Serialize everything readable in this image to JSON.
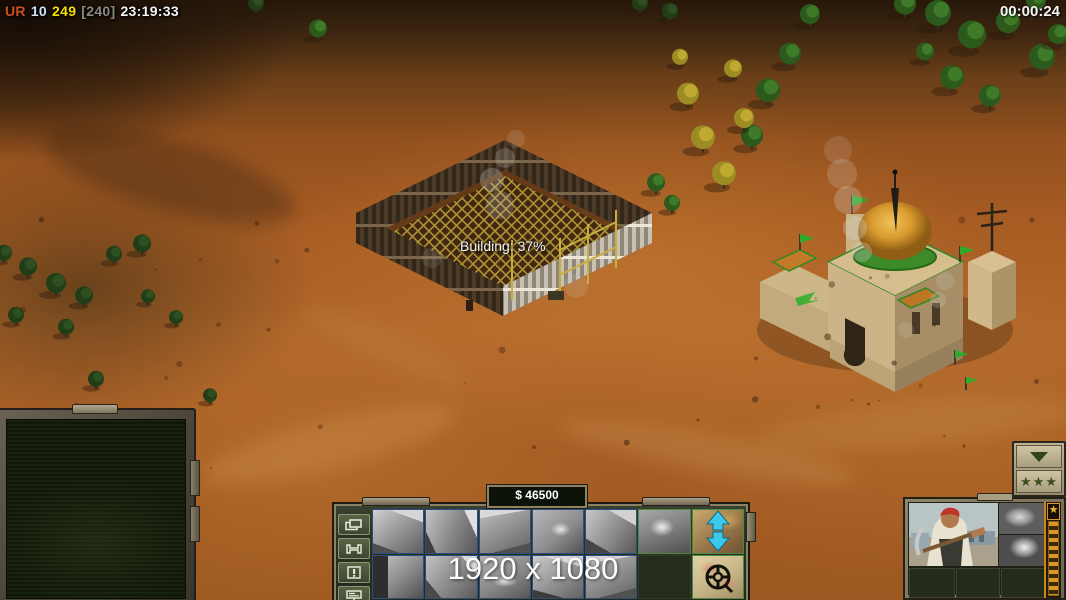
{
  "hud": {
    "score": {
      "tag": "UR",
      "num1": "10",
      "num2": "249",
      "bracket": "[240]",
      "clock": "23:19:33"
    },
    "mission_timer": "00:00:24",
    "building_progress_label": "Building: 37%",
    "resolution_overlay": "1920 x 1080"
  },
  "colors": {
    "score_tag": "#cf4f1d",
    "score_num1": "#cfe4f4",
    "score_num2": "#f8e000",
    "score_bracket": "#8a8a84",
    "clock": "#f4f4f4",
    "timer": "#f5f5f5",
    "money_text": "#ffffff",
    "panel_olive": "#2b3222",
    "panel_tan": "#8d8164",
    "cell_border_blue": "#2c4d80",
    "cell_border_green": "#4c8a44",
    "arrow_cyan": "#3cc8e8",
    "veterancy_gold": "#d89828",
    "promo_green": "#2f4418",
    "terrain_orange": "#a85d23",
    "dome_gold": "#e2a236",
    "trim_green": "#2f8a24"
  },
  "command_bar": {
    "money": "$ 46500",
    "side_buttons": [
      {
        "name": "layers-button",
        "icon": "layers-icon"
      },
      {
        "name": "wrench-button",
        "icon": "wrench-icon"
      },
      {
        "name": "alert-button",
        "icon": "exclamation-icon"
      },
      {
        "name": "sign-button",
        "icon": "billboard-icon"
      }
    ],
    "build_grid": {
      "rows": [
        [
          {
            "name": "build-option-1",
            "kind": "thumb",
            "style": "t1",
            "border": "blue",
            "icon": "structure-thumb-icon"
          },
          {
            "name": "build-option-2",
            "kind": "thumb",
            "style": "t2",
            "border": "blue",
            "icon": "structure-thumb-icon"
          },
          {
            "name": "build-option-3",
            "kind": "thumb",
            "style": "t3",
            "border": "blue",
            "icon": "structure-thumb-icon"
          },
          {
            "name": "build-option-4",
            "kind": "thumb",
            "style": "t4",
            "border": "blue",
            "icon": "structure-thumb-icon"
          },
          {
            "name": "build-option-5",
            "kind": "thumb",
            "style": "t5",
            "border": "blue",
            "icon": "structure-thumb-icon"
          },
          {
            "name": "build-option-6",
            "kind": "thumb",
            "style": "t6",
            "border": "green",
            "icon": "structure-thumb-icon"
          },
          {
            "name": "tunnel-updown-button",
            "kind": "arrows",
            "style": "t-arrows",
            "border": "green",
            "icon": "up-down-arrows-icon"
          }
        ],
        [
          {
            "name": "build-option-7",
            "kind": "thumb",
            "style": "t7",
            "border": "blue",
            "icon": "truck-thumb-icon"
          },
          {
            "name": "build-option-8",
            "kind": "thumb",
            "style": "t8",
            "border": "blue",
            "icon": "structure-thumb-icon"
          },
          {
            "name": "build-option-9",
            "kind": "thumb",
            "style": "t9",
            "border": "blue",
            "icon": "structure-thumb-icon"
          },
          {
            "name": "build-option-10",
            "kind": "thumb",
            "style": "t10",
            "border": "blue",
            "icon": "structure-thumb-icon"
          },
          {
            "name": "build-option-11",
            "kind": "thumb",
            "style": "t3",
            "border": "blue",
            "icon": "structure-thumb-icon"
          },
          {
            "name": "empty-slot",
            "kind": "empty",
            "style": "",
            "border": "none",
            "icon": ""
          },
          {
            "name": "radar-map-button",
            "kind": "map",
            "style": "t-map",
            "border": "green",
            "icon": "map-magnifier-icon"
          }
        ]
      ]
    }
  },
  "promotion_panel": {
    "collapse_icon": "down-arrow-icon",
    "stars_label": "★★★",
    "rank_stars": 3
  },
  "unit_panel": {
    "portrait": "worker-with-pickaxe",
    "upgrade_slots": [
      "boots-upgrade",
      "attack-upgrade"
    ],
    "rank_icon": "star-icon",
    "empty_slots": 3
  },
  "scene": {
    "construction_site": "gla-structure-under-construction",
    "mosque": "gla-palace-with-gold-dome"
  }
}
